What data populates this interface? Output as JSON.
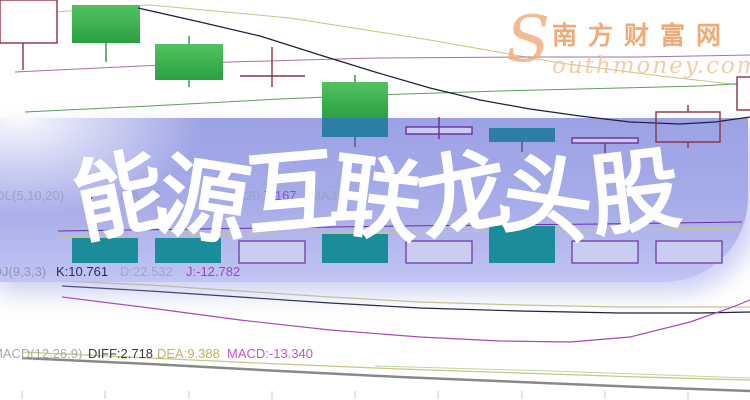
{
  "title": {
    "text": "能源互联龙头股",
    "chars": [
      "能",
      "源",
      "互",
      "联",
      "龙",
      "头",
      "股"
    ],
    "char_rotations": [
      -12,
      9,
      -5,
      7,
      -11,
      9,
      -7
    ],
    "char_offsets_y": [
      4,
      8,
      0,
      6,
      2,
      6,
      0
    ]
  },
  "watermark": {
    "swoosh": "S",
    "brand_cn": "南方财富网",
    "brand_en": "outhmoney.com"
  },
  "indicator_rows": [
    {
      "name": "vol-indicator-row",
      "top": 188,
      "frags": [
        {
          "t": "VOL(5,10,20)",
          "x": -14,
          "c": "#9aa0c6"
        },
        {
          "t": "9",
          "x": 86,
          "c": "#32325e"
        },
        {
          "t": "MA",
          "x": 120,
          "c": "#9aa0c6"
        },
        {
          "t": "2",
          "x": 154,
          "c": "#9aa0c6"
        },
        {
          "t": "MA20:",
          "x": 226,
          "c": "#9aa0c6"
        },
        {
          "t": "7.167",
          "x": 264,
          "c": "#8b55c8"
        },
        {
          "t": "MA3",
          "x": 310,
          "c": "#9aa0c6"
        }
      ]
    },
    {
      "name": "kdj-indicator-row",
      "top": 264,
      "frags": [
        {
          "t": "KDJ(9,3,3)",
          "x": -16,
          "c": "#8f94b8"
        },
        {
          "t": "K:10.761",
          "x": 56,
          "c": "#2c2c50"
        },
        {
          "t": "D:22.532",
          "x": 120,
          "c": "#a0a4c6"
        },
        {
          "t": "J:-12.782",
          "x": 186,
          "c": "#9c45c0"
        }
      ]
    },
    {
      "name": "macd-indicator-row",
      "top": 346,
      "frags": [
        {
          "t": "MACD(12,26,9)",
          "x": -8,
          "c": "#a9a9a9"
        },
        {
          "t": "DIFF:2.718",
          "x": 88,
          "c": "#3c3c3c"
        },
        {
          "t": "DEA:9.388",
          "x": 157,
          "c": "#c2b264"
        },
        {
          "t": "MACD:-13.340",
          "x": 227,
          "c": "#cf4fcf"
        }
      ]
    }
  ],
  "colors": {
    "maroon": "#8a3240",
    "green_dark": "#2e8b43",
    "navy": "#3a5a80",
    "purple": "#6b2f9e",
    "khaki": "#c9c583",
    "mauve": "#a672a6",
    "green_line": "#5aa05a",
    "black_line": "#20203a",
    "magenta": "#a84ab8",
    "gray_line": "#8a8a84",
    "pale_green": "#bcd9a0",
    "teal_candle": "#2e7fa6",
    "teal_bar": "#1b8c9a",
    "lavender_fill": "#c9cdf0",
    "green_top": "#52c261",
    "green_bottom": "#2aa041",
    "tick": "#c8c8c8"
  },
  "chart_data": {
    "type": "candlestick-with-volume-kdj-macd",
    "title_overlay": "能源互联龙头股",
    "axes_labeled": false,
    "indicators": {
      "vol_label": "VOL(5,10,20)",
      "kdj": {
        "label": "KDJ(9,3,3)",
        "K": 10.761,
        "D": 22.532,
        "J": -12.782
      },
      "macd": {
        "label": "MACD(12,26,9)",
        "DIFF": 2.718,
        "DEA": 9.388,
        "MACD": -13.34
      }
    },
    "candles": [
      {
        "x": 0,
        "y": 0,
        "w": 57,
        "h": 43,
        "kind": "hollow_maroon",
        "layer": "base"
      },
      {
        "x": 72,
        "y": 5,
        "w": 68,
        "h": 38,
        "kind": "green",
        "layer": "base"
      },
      {
        "x": 155,
        "y": 44,
        "w": 68,
        "h": 36,
        "kind": "green",
        "layer": "base"
      },
      {
        "x": 322,
        "y": 82,
        "w": 66,
        "h": 36,
        "kind": "green",
        "layer": "base"
      },
      {
        "x": 737,
        "y": 77,
        "w": 14,
        "h": 33,
        "kind": "hollow_maroon",
        "layer": "base"
      },
      {
        "x": 322,
        "y": 118,
        "w": 66,
        "h": 19,
        "kind": "teal",
        "layer": "overlay"
      },
      {
        "x": 406,
        "y": 127,
        "w": 66,
        "h": 7,
        "kind": "hollow_purple",
        "layer": "overlay"
      },
      {
        "x": 489,
        "y": 128,
        "w": 66,
        "h": 14,
        "kind": "teal",
        "layer": "overlay"
      },
      {
        "x": 572,
        "y": 138,
        "w": 66,
        "h": 5,
        "kind": "hollow_purple",
        "layer": "overlay"
      },
      {
        "x": 656,
        "y": 112,
        "w": 64,
        "h": 30,
        "kind": "hollow_open",
        "layer": "overlay"
      }
    ],
    "wicks": [
      {
        "x": 23,
        "y1": 43,
        "y2": 70,
        "color": "maroon",
        "layer": "base"
      },
      {
        "x": 106,
        "y1": 43,
        "y2": 62,
        "color": "green_dark",
        "layer": "base"
      },
      {
        "x": 189,
        "y1": 36,
        "y2": 44,
        "color": "green_dark",
        "layer": "base"
      },
      {
        "x": 189,
        "y1": 80,
        "y2": 87,
        "color": "green_dark",
        "layer": "base"
      },
      {
        "x": 272,
        "y1": 47,
        "y2": 87,
        "color": "maroon",
        "layer": "base"
      },
      {
        "x": 355,
        "y1": 75,
        "y2": 82,
        "color": "green_dark",
        "layer": "base"
      },
      {
        "x": 355,
        "y1": 137,
        "y2": 147,
        "color": "navy",
        "layer": "overlay"
      },
      {
        "x": 439,
        "y1": 117,
        "y2": 139,
        "color": "purple",
        "layer": "overlay"
      },
      {
        "x": 522,
        "y1": 142,
        "y2": 152,
        "color": "navy",
        "layer": "overlay"
      },
      {
        "x": 605,
        "y1": 143,
        "y2": 163,
        "color": "purple",
        "layer": "overlay"
      },
      {
        "x": 688,
        "y1": 105,
        "y2": 112,
        "color": "maroon",
        "layer": "overlay"
      },
      {
        "x": 688,
        "y1": 142,
        "y2": 148,
        "color": "maroon",
        "layer": "overlay"
      }
    ],
    "lines": [
      {
        "name": "ma-khaki",
        "color": "khaki",
        "w": 1,
        "layer": "base",
        "pts": [
          [
            0,
            16
          ],
          [
            150,
            5
          ],
          [
            290,
            18
          ],
          [
            430,
            40
          ],
          [
            560,
            63
          ],
          [
            660,
            76
          ],
          [
            750,
            86
          ]
        ]
      },
      {
        "name": "ma-purple",
        "color": "mauve",
        "w": 1,
        "layer": "base",
        "pts": [
          [
            15,
            72
          ],
          [
            120,
            67
          ],
          [
            230,
            62
          ],
          [
            375,
            58
          ],
          [
            520,
            57
          ],
          [
            640,
            57
          ],
          [
            750,
            55
          ]
        ]
      },
      {
        "name": "ma-green",
        "color": "green_line",
        "w": 1,
        "layer": "base",
        "pts": [
          [
            25,
            112
          ],
          [
            150,
            106
          ],
          [
            280,
            99
          ],
          [
            375,
            95
          ],
          [
            500,
            91
          ],
          [
            620,
            88
          ],
          [
            700,
            86
          ],
          [
            750,
            83
          ]
        ]
      },
      {
        "name": "doji-open-line",
        "color": "maroon",
        "w": 1.5,
        "layer": "base",
        "pts": [
          [
            240,
            76
          ],
          [
            305,
            76
          ]
        ]
      },
      {
        "name": "candle-inner",
        "color": "maroon",
        "w": 1,
        "layer": "base",
        "pts": [
          [
            0,
            29
          ],
          [
            57,
            29
          ]
        ]
      },
      {
        "name": "ma-black",
        "color": "black_line",
        "w": 1.2,
        "layer": "overlay",
        "pts": [
          [
            138,
            8
          ],
          [
            200,
            22
          ],
          [
            260,
            36
          ],
          [
            320,
            55
          ],
          [
            375,
            72
          ],
          [
            430,
            88
          ],
          [
            480,
            100
          ],
          [
            530,
            109
          ],
          [
            580,
            116
          ],
          [
            630,
            122
          ],
          [
            680,
            124
          ],
          [
            715,
            122
          ],
          [
            750,
            117
          ]
        ]
      },
      {
        "name": "vol-ma-purple",
        "color": "purple",
        "w": 1,
        "layer": "overlay",
        "pts": [
          [
            58,
            231
          ],
          [
            200,
            229
          ],
          [
            400,
            226
          ],
          [
            600,
            224
          ],
          [
            742,
            222
          ]
        ]
      },
      {
        "name": "vol-ma-khaki",
        "color": "khaki",
        "w": 1,
        "layer": "overlay",
        "pts": [
          [
            58,
            237
          ],
          [
            250,
            234
          ],
          [
            500,
            231
          ],
          [
            742,
            228
          ]
        ]
      },
      {
        "name": "kdj-k",
        "color": "black_line",
        "w": 1.2,
        "layer": "base",
        "pts": [
          [
            62,
            286
          ],
          [
            150,
            291
          ],
          [
            240,
            297
          ],
          [
            330,
            303
          ],
          [
            420,
            308
          ],
          [
            520,
            311
          ],
          [
            620,
            313
          ],
          [
            700,
            313
          ],
          [
            750,
            312
          ]
        ]
      },
      {
        "name": "kdj-d",
        "color": "khaki",
        "w": 1.2,
        "layer": "base",
        "pts": [
          [
            62,
            281
          ],
          [
            150,
            285
          ],
          [
            240,
            291
          ],
          [
            330,
            297
          ],
          [
            420,
            302
          ],
          [
            520,
            305
          ],
          [
            620,
            307
          ],
          [
            750,
            307
          ]
        ]
      },
      {
        "name": "kdj-j",
        "color": "magenta",
        "w": 1.2,
        "layer": "base",
        "pts": [
          [
            62,
            297
          ],
          [
            150,
            308
          ],
          [
            240,
            320
          ],
          [
            330,
            330
          ],
          [
            420,
            337
          ],
          [
            500,
            341
          ],
          [
            570,
            342
          ],
          [
            630,
            337
          ],
          [
            690,
            322
          ],
          [
            730,
            308
          ],
          [
            750,
            300
          ]
        ]
      },
      {
        "name": "macd-dea",
        "color": "khaki",
        "w": 1.2,
        "layer": "base",
        "pts": [
          [
            22,
            352
          ],
          [
            150,
            358
          ],
          [
            280,
            364
          ],
          [
            400,
            369
          ],
          [
            520,
            373
          ],
          [
            640,
            377
          ],
          [
            750,
            380
          ]
        ]
      },
      {
        "name": "macd-aux",
        "color": "pale_green",
        "w": 1,
        "layer": "base",
        "pts": [
          [
            375,
            366
          ],
          [
            550,
            371
          ],
          [
            750,
            378
          ]
        ]
      },
      {
        "name": "macd-diff",
        "color": "gray_line",
        "w": 2.5,
        "layer": "base",
        "pts": [
          [
            22,
            358
          ],
          [
            150,
            364
          ],
          [
            280,
            371
          ],
          [
            400,
            377
          ],
          [
            520,
            382
          ],
          [
            640,
            387
          ],
          [
            750,
            391
          ]
        ]
      }
    ],
    "volume_baseline": 263,
    "volume_bars": [
      {
        "x": 72,
        "w": 66,
        "top": 238,
        "kind": "teal_bar"
      },
      {
        "x": 155,
        "w": 66,
        "top": 238,
        "kind": "teal_bar"
      },
      {
        "x": 239,
        "w": 66,
        "top": 241,
        "kind": "hollow_purple"
      },
      {
        "x": 322,
        "w": 66,
        "top": 234,
        "kind": "teal_bar"
      },
      {
        "x": 406,
        "w": 66,
        "top": 241,
        "kind": "hollow_purple"
      },
      {
        "x": 489,
        "w": 66,
        "top": 226,
        "kind": "teal_bar"
      },
      {
        "x": 572,
        "w": 66,
        "top": 241,
        "kind": "hollow_purple"
      },
      {
        "x": 656,
        "w": 66,
        "top": 241,
        "kind": "hollow_purple"
      }
    ],
    "axis_ticks": {
      "y1": 391,
      "y2": 399,
      "xs": [
        22,
        105,
        189,
        272,
        355,
        438,
        522,
        605,
        688
      ]
    }
  }
}
